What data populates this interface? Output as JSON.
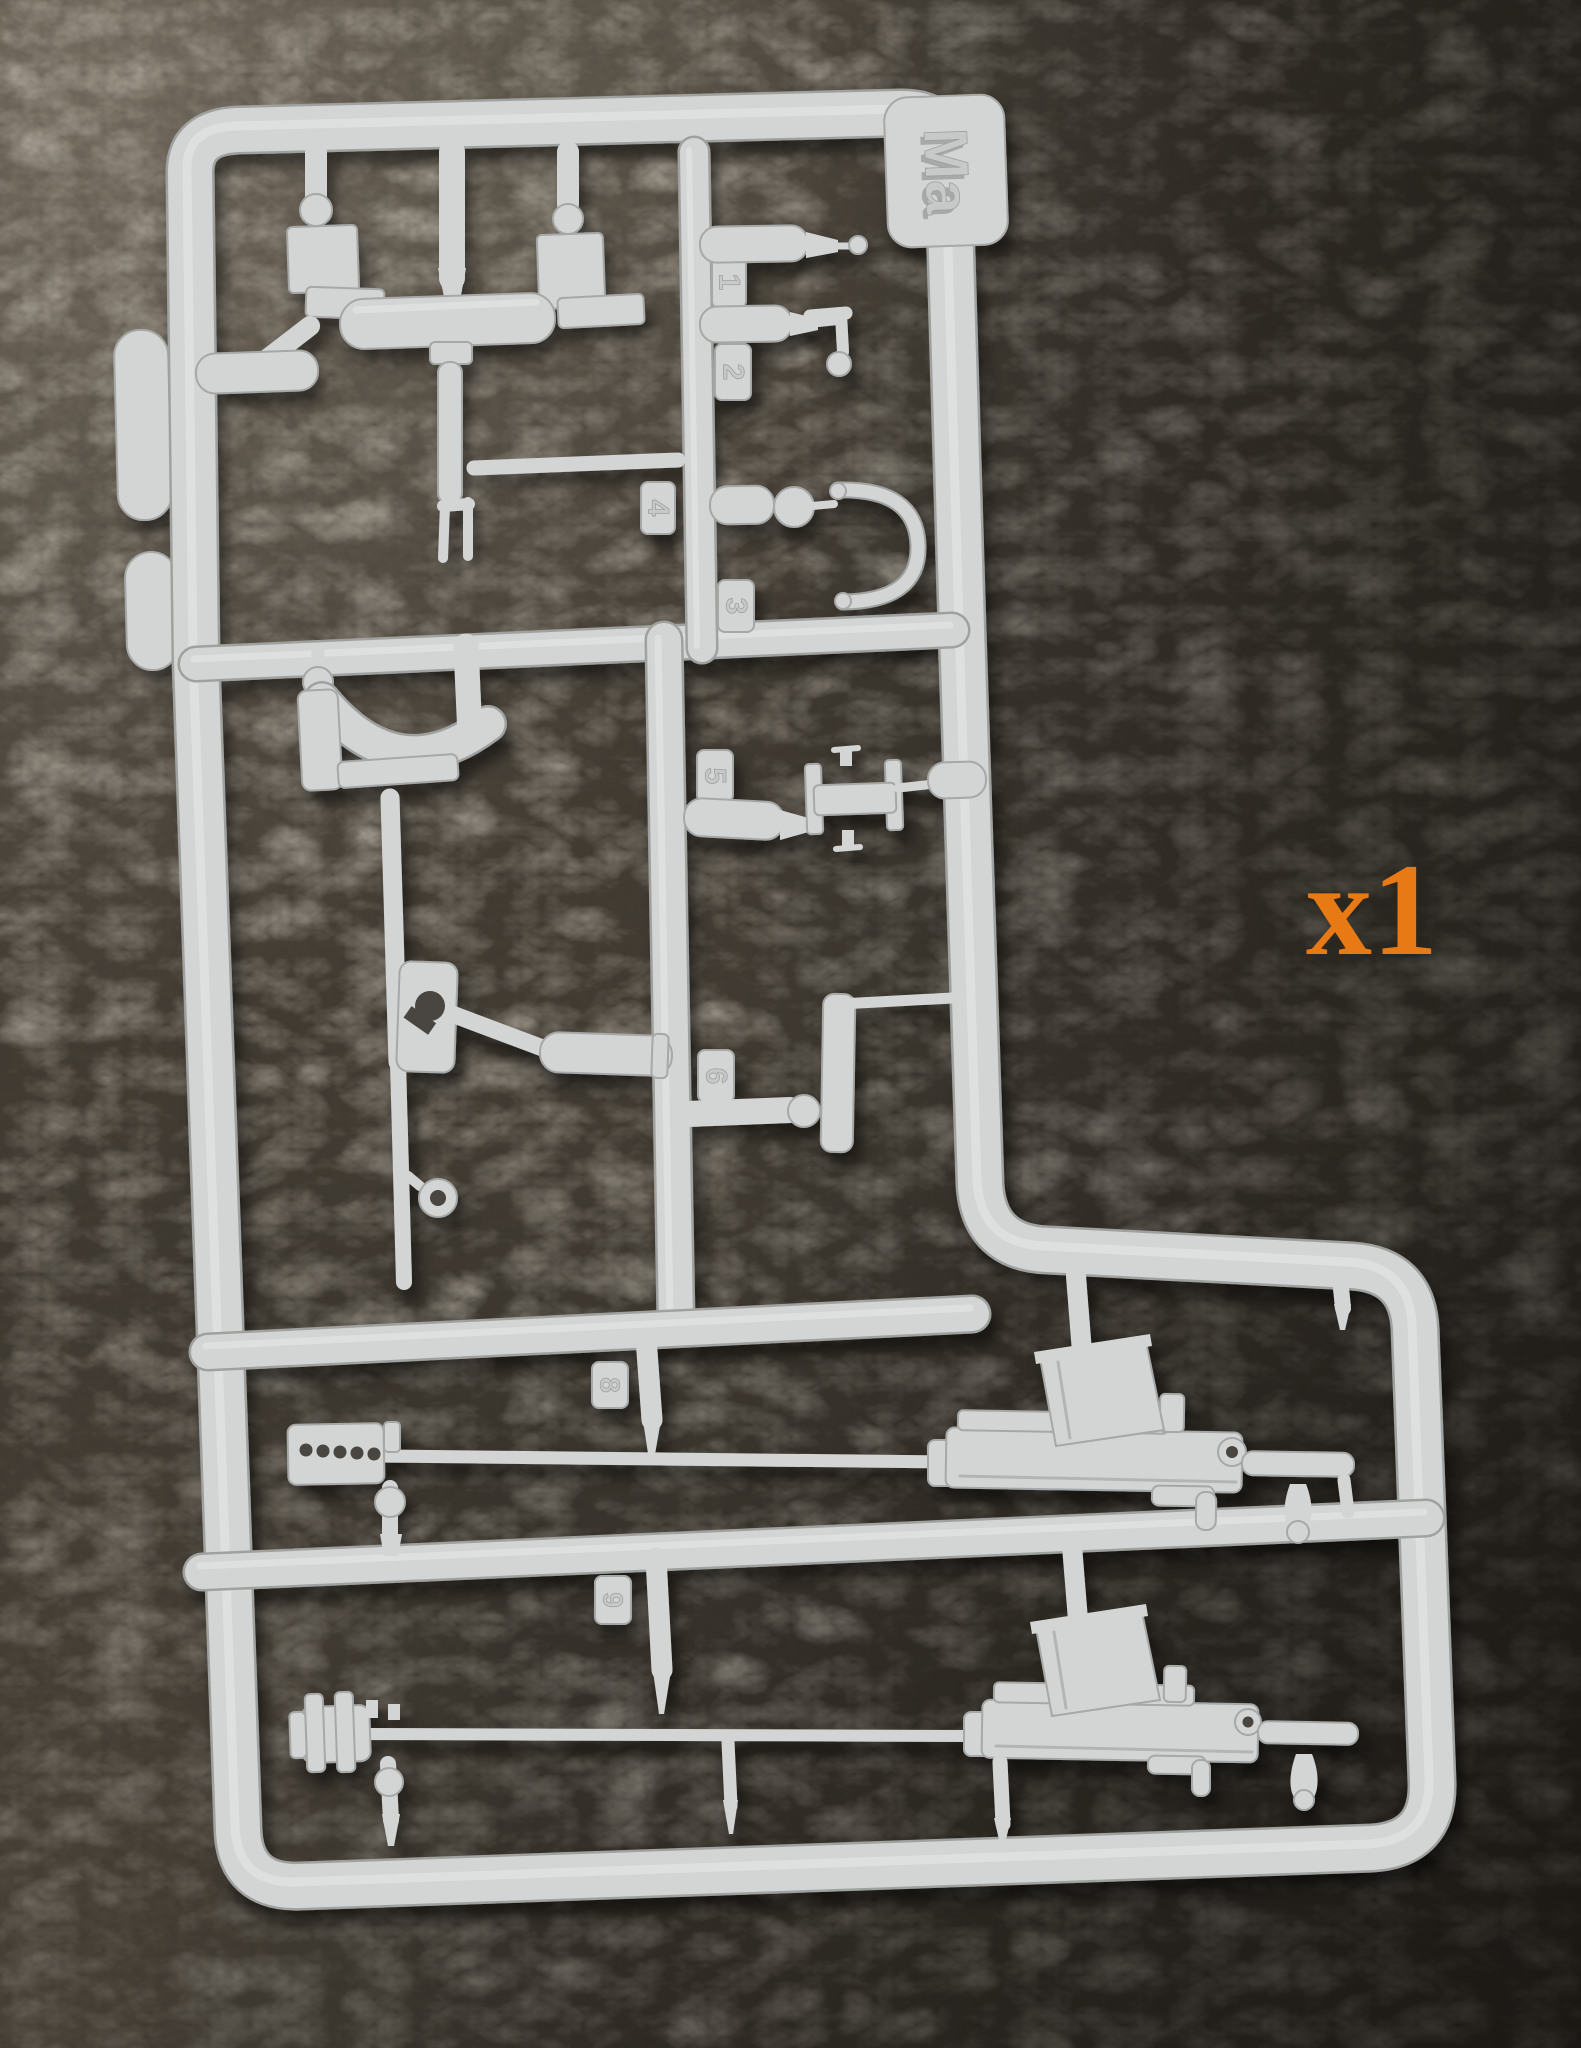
{
  "background": {
    "surface": "dark-leather",
    "base_color": "#423c33",
    "highlight_color": "#8a8172",
    "shadow_color": "#211e1a"
  },
  "sprue": {
    "plastic_color": "#d3d5d4",
    "gate_tag_label": "Ma",
    "part_tags": [
      {
        "label": "1"
      },
      {
        "label": "2"
      },
      {
        "label": "3"
      },
      {
        "label": "4"
      },
      {
        "label": "5"
      },
      {
        "label": "6"
      },
      {
        "label": "8"
      },
      {
        "label": "9"
      }
    ]
  },
  "annotation": {
    "quantity_label": "x1",
    "color": "#e87a16"
  }
}
